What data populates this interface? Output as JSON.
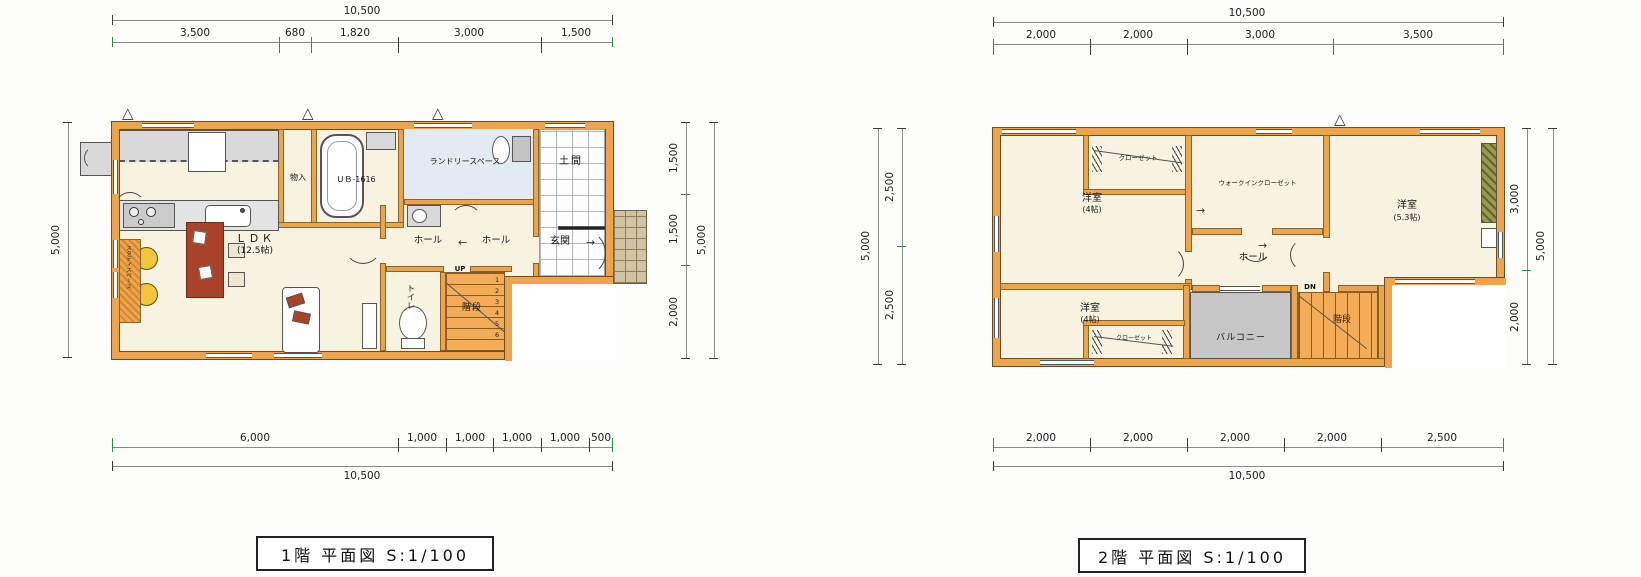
{
  "palette": {
    "wall": "#eda44f",
    "floor": "#f8f3e1",
    "laundry_floor": "#e2ebf1",
    "balcony_floor": "#c6c6c6",
    "stair_fill": "#f3ad58",
    "table_red": "#a8432a",
    "chair_yellow": "#f2c53d"
  },
  "icons": {
    "arrow_left": "←",
    "arrow_right": "→",
    "vent": "△"
  },
  "floor1": {
    "title": "1階 平面図 S:1/100",
    "dims": {
      "top_total": "10,500",
      "top_segments": [
        "3,500",
        "680",
        "1,820",
        "3,000",
        "1,500"
      ],
      "bottom_segments": [
        "6,000",
        "1,000",
        "1,000",
        "1,000",
        "1,000",
        "500"
      ],
      "bottom_total": "10,500",
      "left_total": "5,000",
      "right_segments": [
        "1,500",
        "1,500",
        "2,000"
      ],
      "right_total": "5,000"
    },
    "labels": {
      "ldk": "ＬＤＫ",
      "ldk_size": "(12.5帖)",
      "storage": "物入",
      "bath": "ＵＢ-1616",
      "laundry": "ランドリースペース",
      "doma": "土間",
      "hall_a": "ホール",
      "hall_b": "ホール",
      "entry": "玄関",
      "toilet": "トイレ",
      "stairs": "階段",
      "up": "UP",
      "study": "スタディスペース",
      "steps": [
        "1",
        "2",
        "3",
        "4",
        "5",
        "6"
      ]
    }
  },
  "floor2": {
    "title": "2階 平面図 S:1/100",
    "dims": {
      "top_total": "10,500",
      "top_segments": [
        "2,000",
        "2,000",
        "3,000",
        "3,500"
      ],
      "bottom_segments": [
        "2,000",
        "2,000",
        "2,000",
        "2,000",
        "2,500"
      ],
      "bottom_total": "10,500",
      "left_segments": [
        "2,500",
        "2,500"
      ],
      "left_total": "5,000",
      "right_segments": [
        "3,000",
        "2,000"
      ],
      "right_total": "5,000"
    },
    "labels": {
      "bedroom_nw": "洋室",
      "bedroom_nw_size": "(4帖)",
      "closet_nw": "クローゼット",
      "wic": "ウォークインクローゼット",
      "bedroom_e": "洋室",
      "bedroom_e_size": "(5.3帖)",
      "hall": "ホール",
      "bedroom_sw": "洋室",
      "bedroom_sw_size": "(4帖)",
      "closet_sw": "クローゼット",
      "balcony": "バルコニー",
      "stairs": "階段",
      "dn": "DN"
    }
  }
}
